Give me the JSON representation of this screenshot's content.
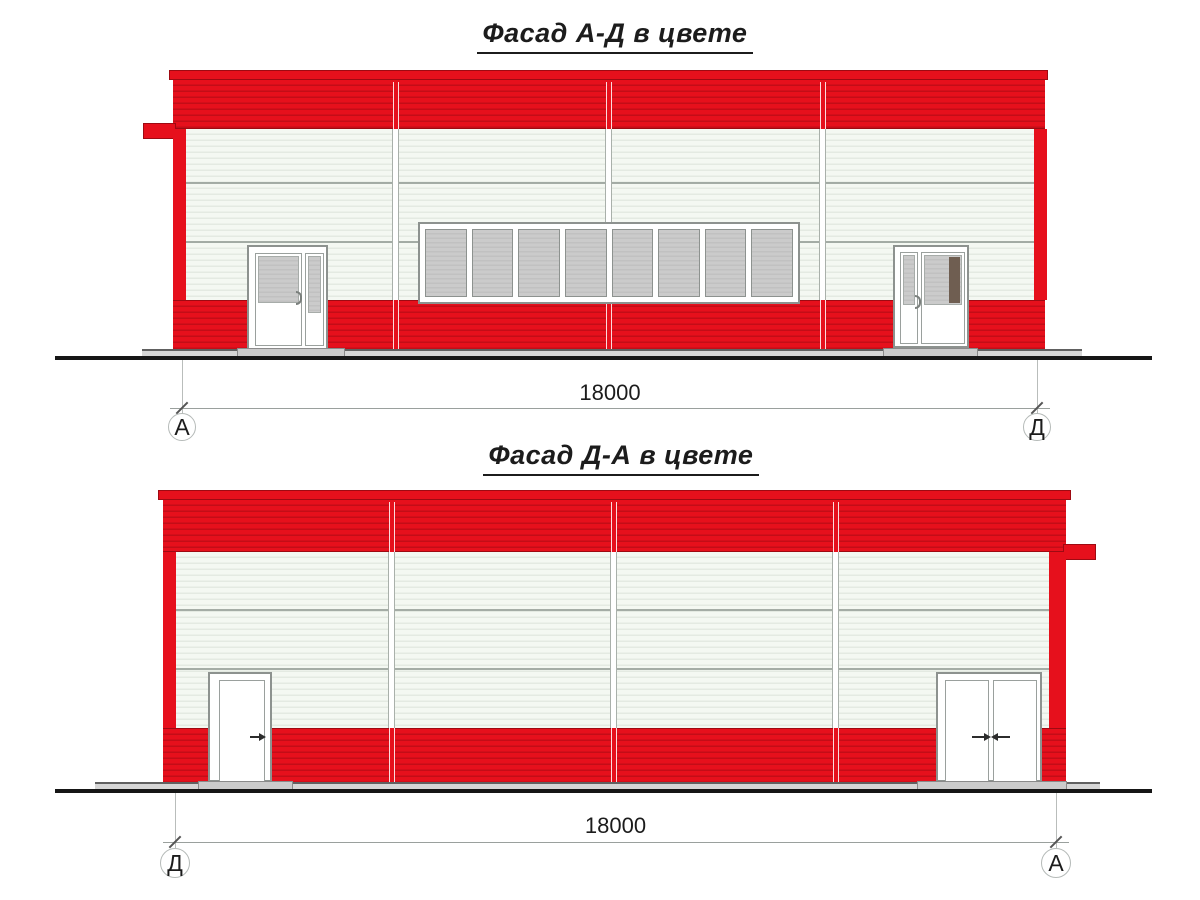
{
  "facade_ad": {
    "title": "Фасад А-Д в цвете",
    "dimension_label": "18000",
    "axis_left": "А",
    "axis_right": "Д",
    "window_pane_count": 8
  },
  "facade_da": {
    "title": "Фасад Д-А в цвете",
    "dimension_label": "18000",
    "axis_left": "Д",
    "axis_right": "А"
  },
  "colors": {
    "facade_red": "#e6101c",
    "facade_red_stripe": "#c30d17",
    "facade_red_dark": "#9e0a12",
    "panel_white": "#f4f8f2",
    "panel_white_stripe": "#e4eae2",
    "panel_joint_gray": "#97a099",
    "glass_gray": "#cbcbcb",
    "glass_stripe": "#c1c1c1",
    "frame_gray": "#8d928f",
    "door_dark_panel": "#6f5e51",
    "concrete_gray": "#d6d6d6",
    "ground_black": "#161616",
    "dim_gray": "#9aa09d",
    "text_black": "#1c1c1c"
  }
}
